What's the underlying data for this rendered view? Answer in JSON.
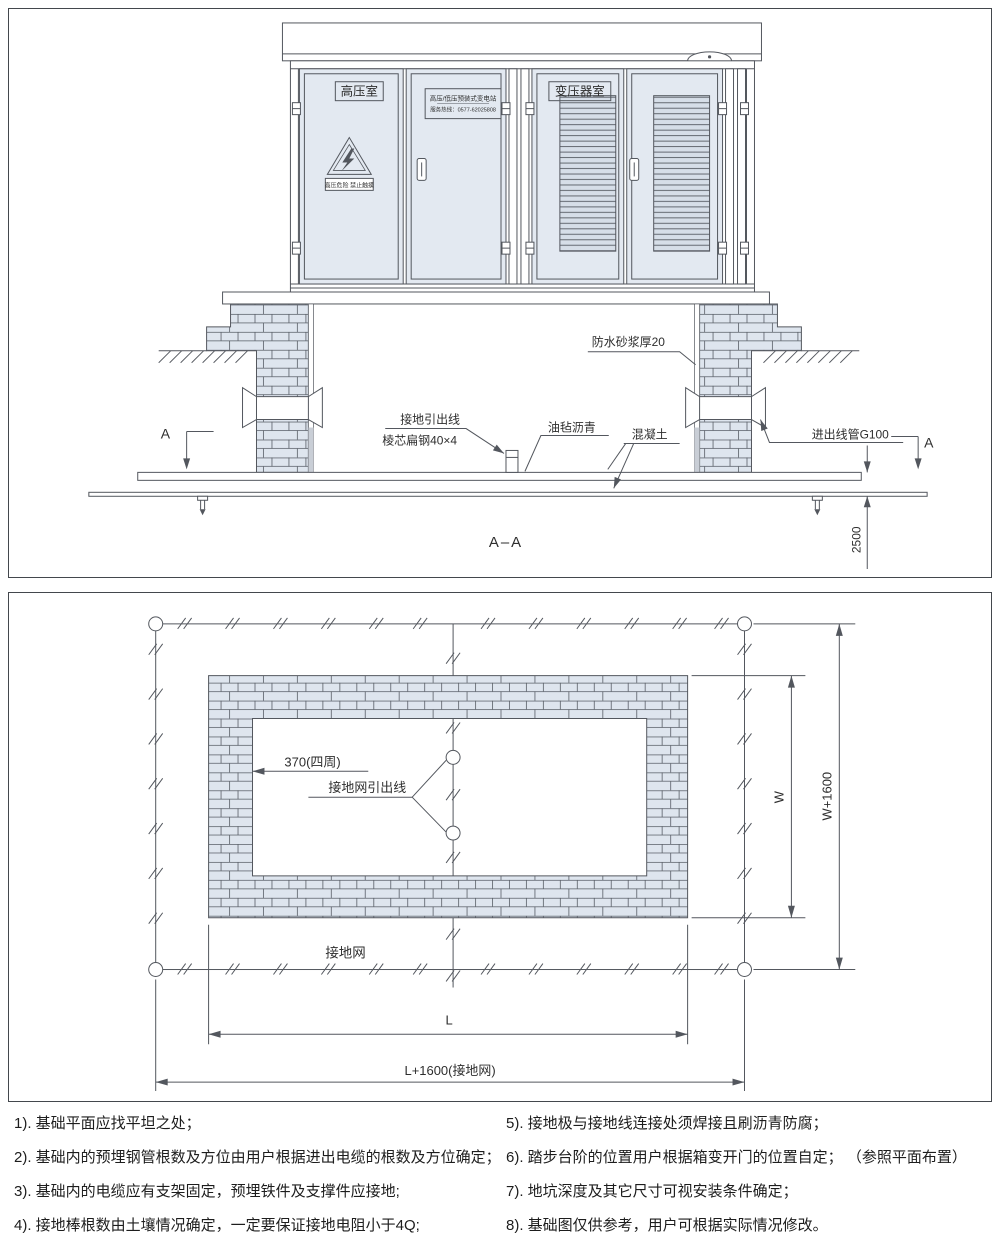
{
  "colors": {
    "line": "#53575e",
    "brick_fill": "#dee5ee",
    "door_fill": "#e3e9f1",
    "text": "#2e2e2e"
  },
  "elevation": {
    "title": "A–A",
    "section_mark": "A",
    "room_hv": "高压室",
    "room_transformer": "变压器室",
    "nameplate1": "高压/低压预装式变电站",
    "nameplate2": "服务热线：0577-62025808",
    "warning": "高压危险 禁止触摸",
    "mortar": "防水砂浆厚20",
    "lead1": "接地引出线",
    "lead2": "棱芯扁钢40×4",
    "felt": "油毡沥青",
    "concrete": "混凝土",
    "conduit": "进出线管G100",
    "depth": "2500"
  },
  "plan": {
    "thickness": "370(四周)",
    "lead": "接地网引出线",
    "grid": "接地网",
    "dim_l": "L",
    "dim_l_total": "L+1600(接地网)",
    "dim_w": "W",
    "dim_w_total": "W+1600"
  },
  "notes": [
    "1). 基础平面应找平坦之处；",
    "2). 基础内的预埋钢管根数及方位由用户根据进出电缆的根数及方位确定；",
    "3). 基础内的电缆应有支架固定，预埋铁件及支撑件应接地;",
    "4). 接地棒根数由土壤情况确定，一定要保证接地电阻小于4Q;",
    "5). 接地极与接地线连接处须焊接且刷沥青防腐；",
    "6). 踏步台阶的位置用户根据箱变开门的位置自定；  （参照平面布置）",
    "7). 地坑深度及其它尺寸可视安装条件确定；",
    "8). 基础图仅供参考，用户可根据实际情况修改。"
  ]
}
